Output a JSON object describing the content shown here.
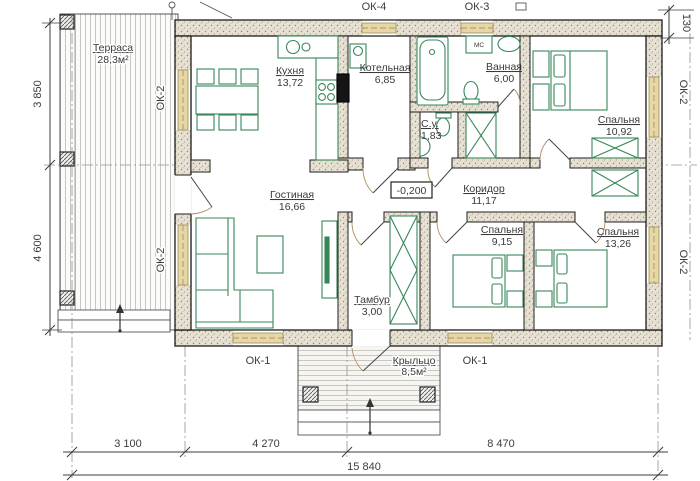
{
  "rooms": {
    "terrace": {
      "name": "Терраса",
      "area": "28,3м²"
    },
    "kitchen": {
      "name": "Кухня",
      "area": "13,72"
    },
    "boiler": {
      "name": "Котельная",
      "area": "6,85"
    },
    "bathroom": {
      "name": "Ванная",
      "area": "6,00"
    },
    "wc": {
      "name": "С.у.",
      "area": "1,83"
    },
    "bedroom1": {
      "name": "Спальня",
      "area": "10,92"
    },
    "living": {
      "name": "Гостиная",
      "area": "16,66"
    },
    "corridor": {
      "name": "Коридор",
      "area": "11,17"
    },
    "tambour": {
      "name": "Тамбур",
      "area": "3,00"
    },
    "bedroom2": {
      "name": "Спальня",
      "area": "9,15"
    },
    "bedroom3": {
      "name": "Спальня",
      "area": "13,26"
    },
    "porch": {
      "name": "Крыльцо",
      "area": "8,5м²"
    }
  },
  "labels": {
    "elevation": "-0,200",
    "washing_machine": "МС",
    "windows": {
      "ok1": "ОК-1",
      "ok2": "ОК-2",
      "ok3": "ОК-3",
      "ok4": "ОК-4"
    }
  },
  "dimensions": {
    "left_top": "3 850",
    "left_bottom": "4 600",
    "bottom_1": "3 100",
    "bottom_2": "4 270",
    "bottom_3": "8 470",
    "bottom_total": "15 840",
    "top_right": "130"
  },
  "colors": {
    "furniture_green": "#37875a",
    "wall_fill": "#e7e1d3",
    "window_fill": "#e8d7a6",
    "door_arc": "#b08d62"
  }
}
